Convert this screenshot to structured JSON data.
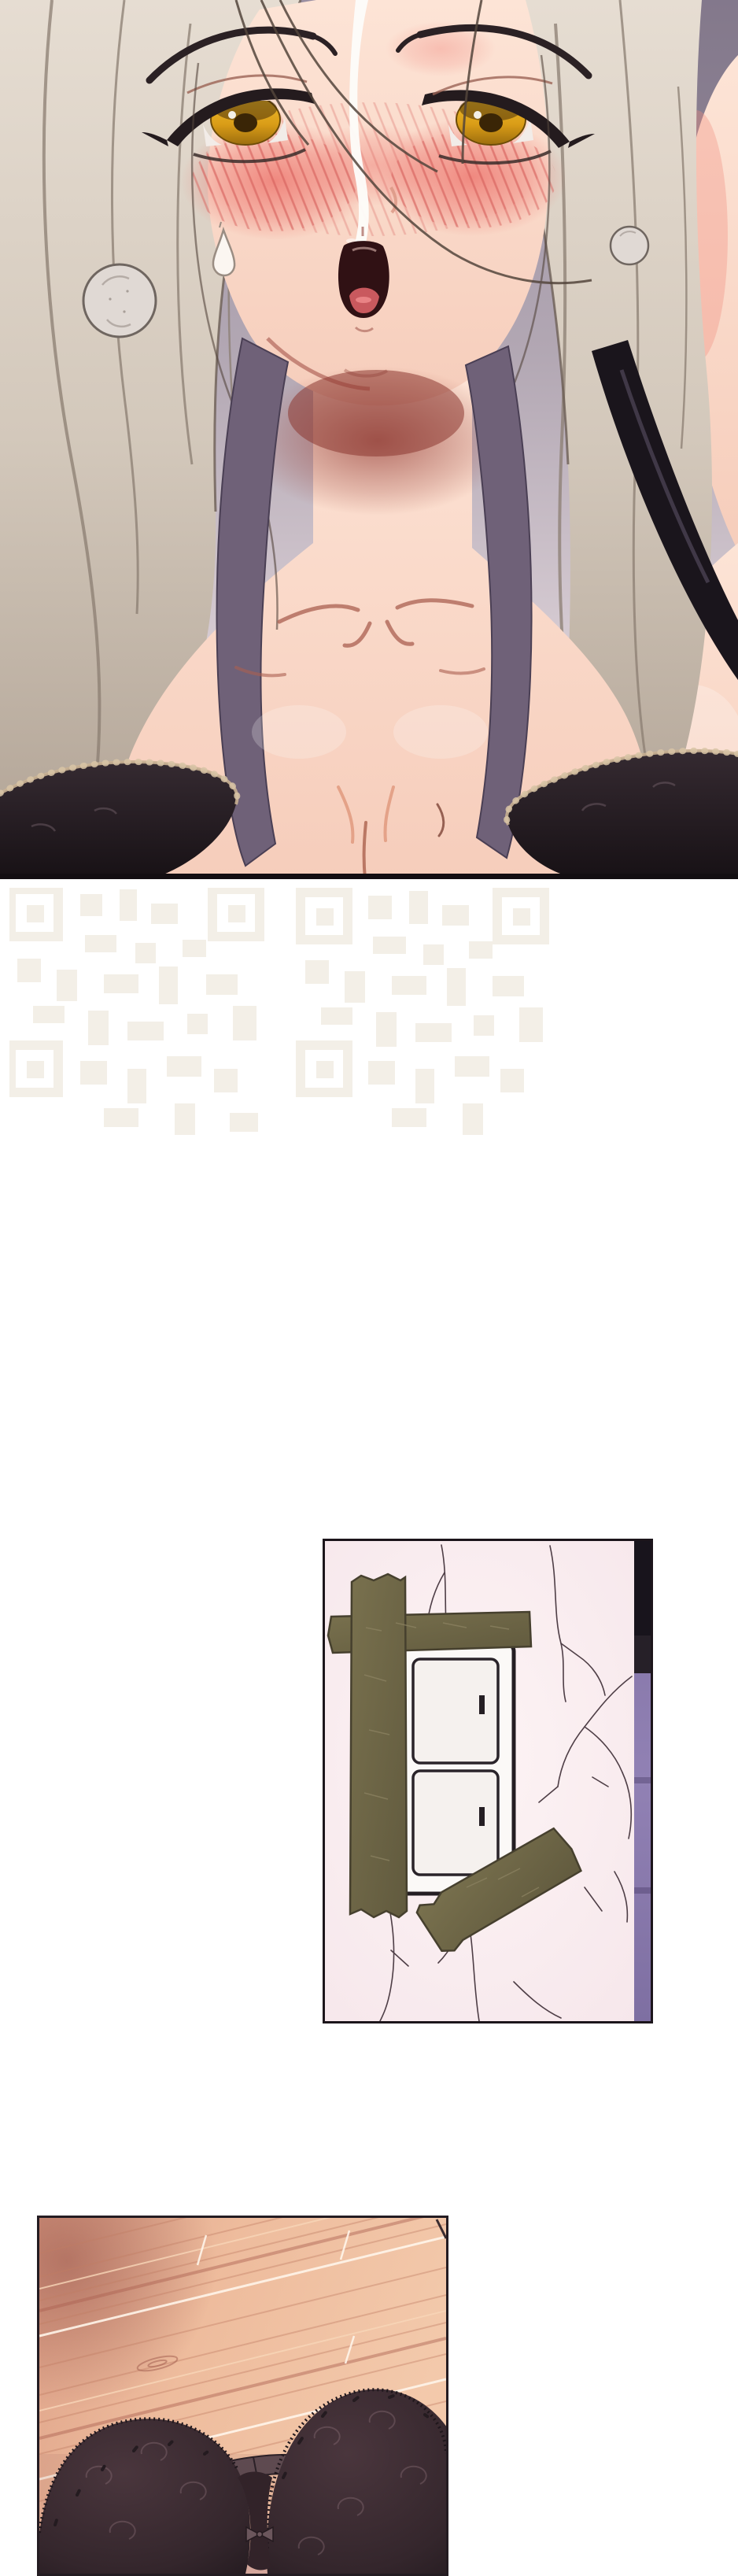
{
  "page": {
    "kind": "vertical webtoon comic strip page",
    "background": "#ffffff",
    "content_note": "no text visible on page"
  },
  "panels": {
    "portrait": {
      "name": "portrait-panel",
      "description": "Full-bleed close-up of a blushing woman with long pale hair, amber half-lidded eyes and parted lips, wearing a dark lace bra with a black strap",
      "palette": {
        "background": "#9a8fa2",
        "hair": "#d3c8bb",
        "skin": "#fbdccd",
        "blush": "#ee8e87",
        "eyes": "#d99c17",
        "mouth": "#301114",
        "bra": "#241c21",
        "lace_trim": "#c9b193"
      }
    },
    "wall": {
      "name": "wall-switch-panel",
      "description": "Cracked pale-pink wall with a double light switch plate covered by torn strips of olive tape; dark door edge on the right",
      "palette": {
        "wall": "#f8ecef",
        "cracks": "#4e3e46",
        "tape": "#6e6747",
        "switch_plate": "#fbf9f7",
        "door_edge_top": "#18141c",
        "door_edge": "#8d7cb0"
      }
    },
    "floor": {
      "name": "floor-panel",
      "description": "Black lace bra lying on a warm diagonal-plank wooden floor",
      "palette": {
        "wood_light": "#f3c9ab",
        "wood_dark": "#ad7265",
        "plank_seam": "#fff5ea",
        "bra": "#34262c",
        "strap": "#5e4a50",
        "pink_lace": "#d5a79c"
      }
    }
  },
  "watermark": {
    "icon": "qr-watermark",
    "description": "Two very faint QR-code-like watermark patterns on the white gap",
    "color": "#f3efe7",
    "count": 2
  }
}
